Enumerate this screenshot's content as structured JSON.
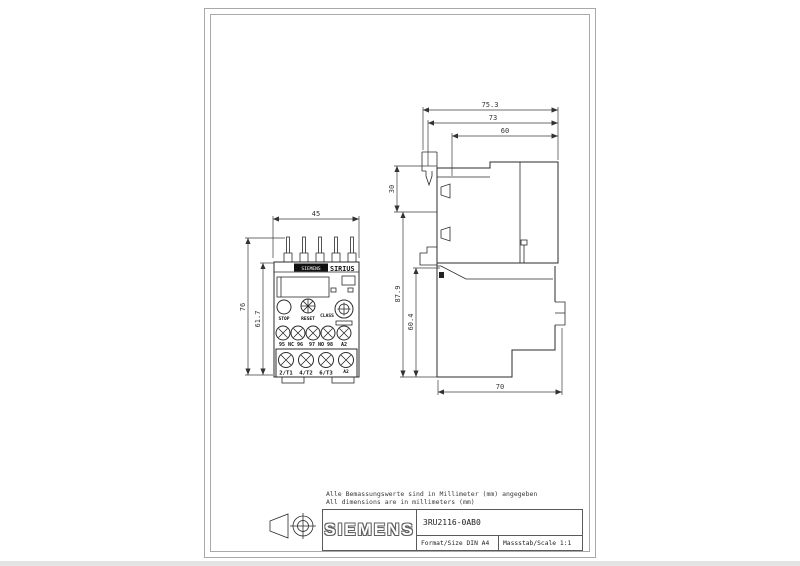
{
  "sheet": {
    "notes": {
      "line1": "Alle Bemassungswerte sind in Millimeter (mm) angegeben",
      "line2": "All dimensions are in millimeters (mm)"
    },
    "title_block": {
      "logo": "SIEMENS",
      "part_number": "3RU2116-0AB0",
      "format_label": "Format/Size DIN A4",
      "scale_label": "Massstab/Scale 1:1"
    }
  },
  "front_view": {
    "dims": {
      "width": "45",
      "height_total": "76",
      "height_upper": "61.7"
    },
    "labels": {
      "brand": "SIEMENS",
      "series": "SIRIUS",
      "stop": "STOP",
      "reset": "RESET",
      "class": "CLASS",
      "aux_terminals": [
        "95 NC 96",
        "97 NO 98",
        "A2"
      ],
      "main_terminals": [
        "2/T1",
        "4/T2",
        "6/T3",
        "A2"
      ]
    }
  },
  "side_view": {
    "dims": {
      "depth_total": "75.3",
      "depth_housing": "73",
      "depth_front": "60",
      "height_top": "30",
      "height_total": "87.9",
      "height_lower": "60.4",
      "width_bottom": "70"
    }
  }
}
